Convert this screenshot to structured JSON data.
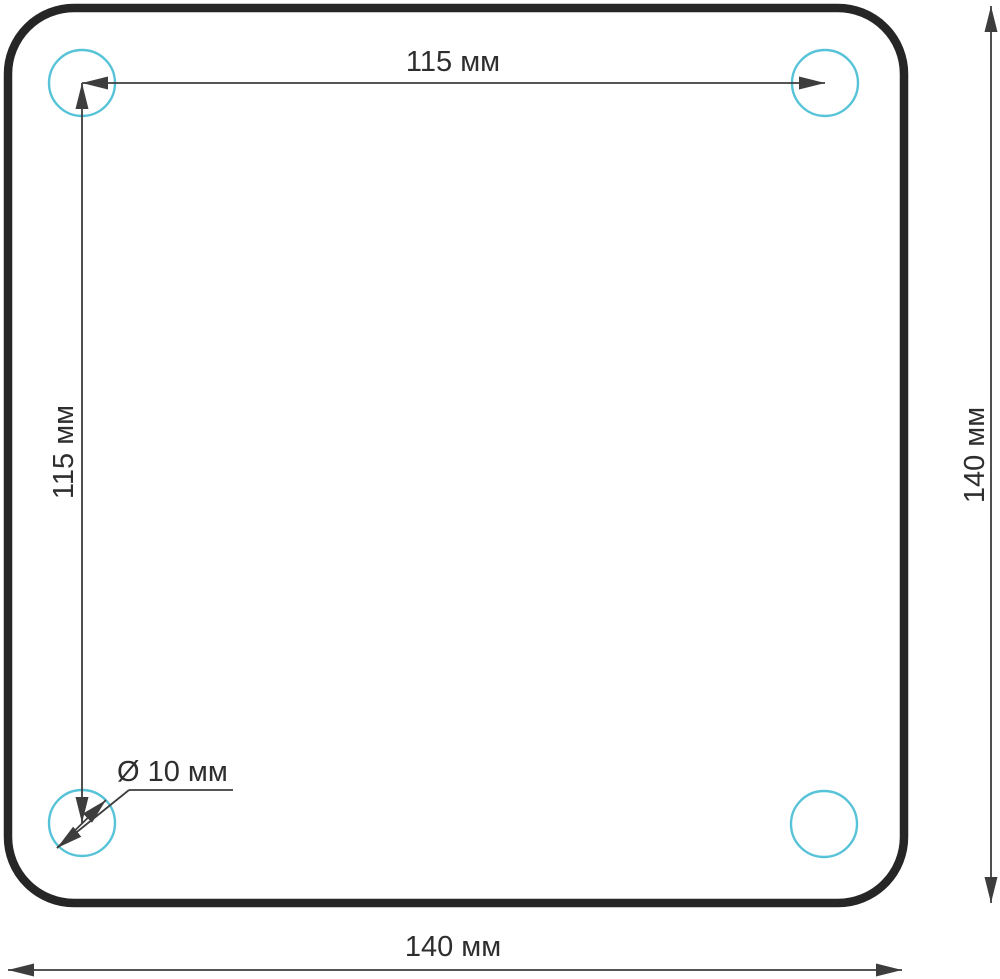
{
  "drawing": {
    "unit": "мм",
    "labels": {
      "hole_spacing_horizontal": "115 мм",
      "hole_spacing_vertical": "115 мм",
      "plate_height": "140 мм",
      "plate_width": "140 мм",
      "hole_diameter": "Ø 10 мм"
    },
    "values": {
      "hole_spacing_horizontal_mm": 115,
      "hole_spacing_vertical_mm": 115,
      "plate_width_mm": 140,
      "plate_height_mm": 140,
      "hole_diameter_mm": 10
    },
    "colors": {
      "outline": "#262626",
      "dimension": "#3d3d3d",
      "hole": "#57c3d8",
      "background": "#ffffff",
      "text": "#2e2e2e"
    }
  }
}
